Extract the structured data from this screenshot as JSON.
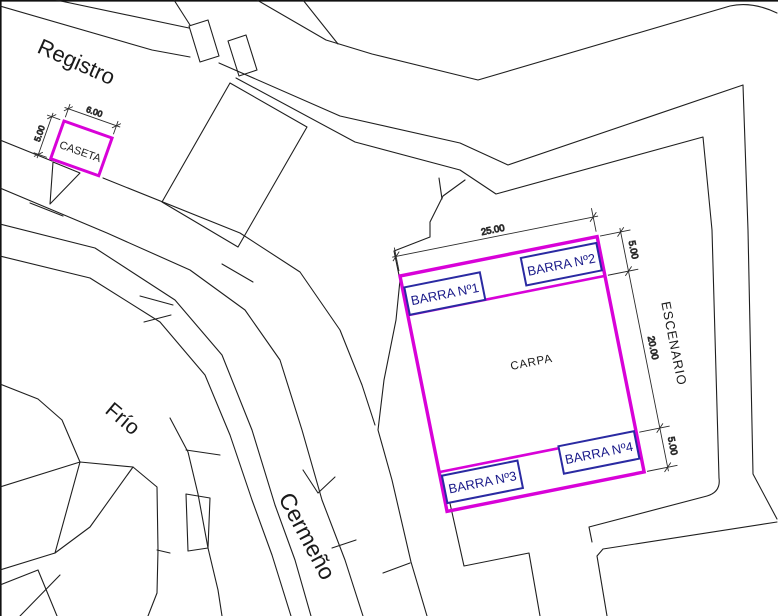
{
  "plan": {
    "streets": {
      "registro": "Registro",
      "frio": "Frío",
      "cermeno": "Cermeño"
    },
    "caseta": {
      "label": "CASETA",
      "dim_width": "6.00",
      "dim_height": "5.00"
    },
    "carpa": {
      "label": "CARPA",
      "stage_label": "ESCENARIO",
      "dim_width": "25.00",
      "dim_top_strip": "5.00",
      "dim_middle": "20.00",
      "dim_bottom_strip": "5.00",
      "bars": [
        {
          "label": "BARRA Nº1"
        },
        {
          "label": "BARRA Nº2"
        },
        {
          "label": "BARRA Nº3"
        },
        {
          "label": "BARRA Nº4"
        }
      ]
    },
    "colors": {
      "outline_magenta": "#d802d8",
      "bar_navy": "#2a2aa2",
      "line_black": "#1f1f1f",
      "background": "#ffffff"
    }
  }
}
